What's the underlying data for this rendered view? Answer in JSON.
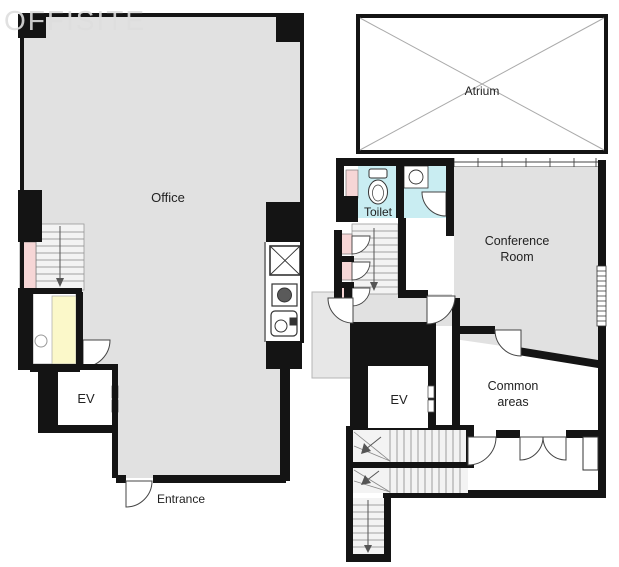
{
  "watermark": {
    "text": "OFFISITE"
  },
  "colors": {
    "wall": "#141414",
    "room_gray": "#e1e1e1",
    "stairs_gray": "#f3f3f3",
    "balcony_gray": "#e7e7e7",
    "pink": "#f6d6d6",
    "yellow": "#fbf8c9",
    "cyan": "#c9edf2",
    "outline": "#333333"
  },
  "floor1": {
    "office_label": "Office",
    "entrance_label": "Entrance",
    "elevator_label": "EV"
  },
  "floor2": {
    "atrium_label": "Atrium",
    "toilet_label": "Toilet",
    "conference_line1": "Conference",
    "conference_line2": "Room",
    "common_line1": "Common",
    "common_line2": "areas",
    "elevator_label": "EV"
  },
  "icons": {
    "toilet": "toilet-bowl-icon",
    "sink": "round-sink-icon",
    "stove": "stove-burner-icon",
    "shaft": "x-box-icon",
    "stairs": "stairs-down-arrow-icon",
    "door": "door-swing-icon"
  }
}
